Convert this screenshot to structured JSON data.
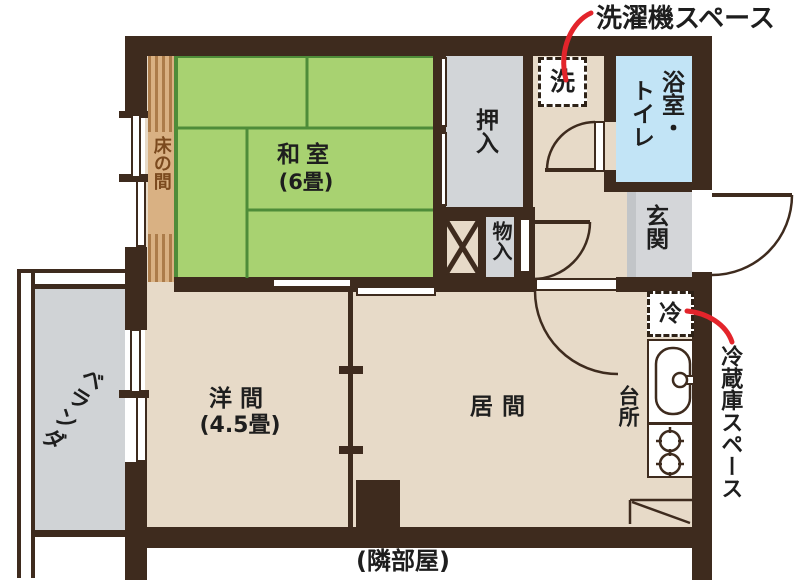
{
  "annotations": {
    "washer_space": "洗濯機スペース",
    "fridge_space": "冷蔵庫スペース",
    "neighbor_room": "(隣部屋)"
  },
  "rooms": {
    "washitsu_name": "和室",
    "washitsu_size": "(6畳)",
    "youma_name": "洋間",
    "youma_size": "(4.5畳)",
    "ima_name": "居間",
    "oshiire": "押入",
    "mononyu": "物入",
    "bath_line_right": "浴室・",
    "bath_line_left": "トイレ",
    "genkan": "玄関",
    "daidokoro": "台所",
    "tokonoma": "床の間",
    "veranda": "ベランダ",
    "washer_mark": "洗",
    "fridge_mark": "冷"
  },
  "colors": {
    "wall": "#3E2B1E",
    "floor_beige": "#E7DAC8",
    "tatami_green": "#A8D271",
    "tatami_line": "#4E8C39",
    "tokonoma_tan": "#D9B183",
    "gray_area": "#D2D5D8",
    "bath_blue": "#C2E4F6",
    "annotation_red": "#E3242B",
    "text_dark": "#1E1E1E",
    "tokonoma_text": "#7B4A1E"
  }
}
